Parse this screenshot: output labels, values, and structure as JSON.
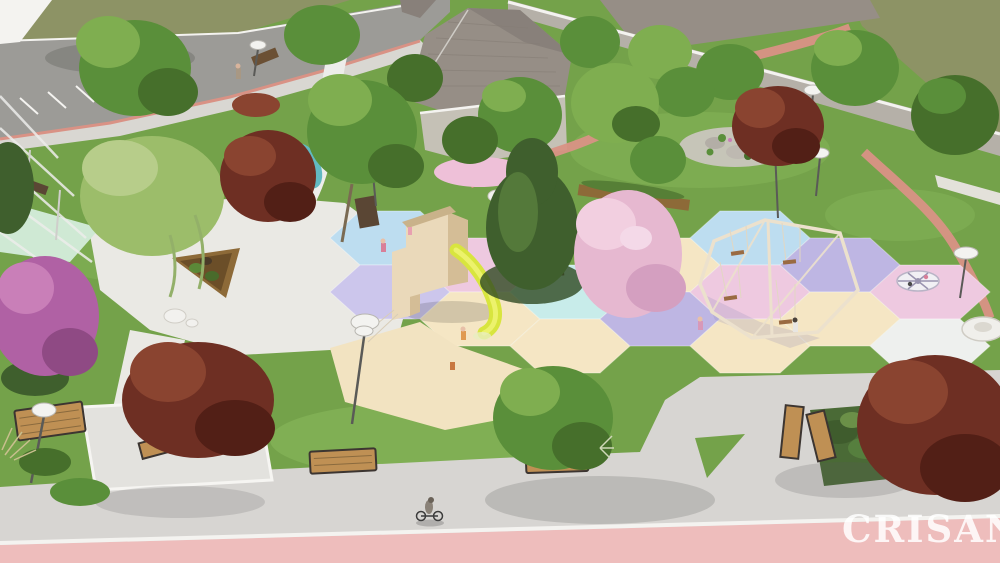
{
  "scene": {
    "title": "Park playground aerial 3D render",
    "type": "architectural-visualization",
    "watermark": "CRISANA",
    "description": "Aerial 3D render of a neighborhood park: pastel hexagonal playground surfacing with a wooden play tower and yellow slide, a hexagonal swing frame, two carousels, lawns with winding pink gravel paths, a white plaza with a triangular wooden planter, benches, globe lampposts, green / burgundy / blossom trees, a road with parking at top-left, houses with gray hip roofs behind a boundary wall at top, and a wide gray promenade with a cyclist and a pink bike lane at the bottom.",
    "features": [
      "lawn",
      "olive field",
      "road with parking stalls",
      "sidewalk",
      "houses",
      "boundary wall",
      "white plaza",
      "triangular planter",
      "pergola",
      "mint pad",
      "pond",
      "pink gravel paths",
      "hexagonal safety tiles",
      "play tower",
      "yellow slide",
      "swing frame",
      "carousel spinner",
      "disc spinner",
      "benches",
      "globe lampposts",
      "trees",
      "rock garden",
      "planting bed",
      "cyclist",
      "children",
      "bike lane",
      "watermark"
    ]
  },
  "palette": {
    "grass_base": "#74a24a",
    "grass_light": "#8ab95c",
    "field_olive": "#8d9365",
    "road_gray": "#9c9b97",
    "sidewalk_gray": "#d9d7d2",
    "promenade": "#d7d5d2",
    "bike_lane_pink": "#eebdbc",
    "curb_white": "#f4f3f0",
    "plaza_white": "#eae9e4",
    "pad_white": "#e3e2de",
    "mint": "#cfe9d4",
    "pond_teal": "#62b9c2",
    "path_white": "#ededea",
    "path_pink": "#d99285",
    "roof_gray": "#968e86",
    "roof_dark": "#88807a",
    "wall_gray": "#b5b0a8",
    "house_wall": "#c5c1b6",
    "hex_blue": "#bdddf0",
    "hex_lavender": "#beb6e3",
    "hex_lavender_light": "#ccc6ec",
    "hex_pink": "#eec9e0",
    "hex_cream": "#f5e6c4",
    "hex_cyan": "#c8ecea",
    "hex_white": "#eef0ee",
    "sand": "#f2e3c1",
    "slide_yellow": "#d8e53e",
    "play_wood": "#ead9ba",
    "play_wood_dark": "#d4bd96",
    "swing_frame": "#ece1cd",
    "seat_brown": "#9a6b42",
    "tree_green": "#5a8f3a",
    "tree_green_light": "#7fae50",
    "tree_green_dark": "#466f2b",
    "tree_lime": "#9cbd6a",
    "conifer": "#3f5f2d",
    "conifer_light": "#54793a",
    "tree_burgundy": "#6e2f23",
    "tree_burgundy_light": "#8a4430",
    "tree_burgundy_dark": "#521f16",
    "blossom_pink": "#e6b8d0",
    "blossom_pink_light": "#f2cfe0",
    "blossom_magenta": "#b061a4",
    "blossom_magenta_light": "#c97fb8",
    "bench_wood": "#bf9054",
    "bench_frame": "#3c3531",
    "planter_wood": "#8d6a38",
    "lamp_white": "#f3f3f0",
    "lamp_pole": "#5a5a57",
    "watermark_color": "rgba(255,255,255,0.85)"
  }
}
